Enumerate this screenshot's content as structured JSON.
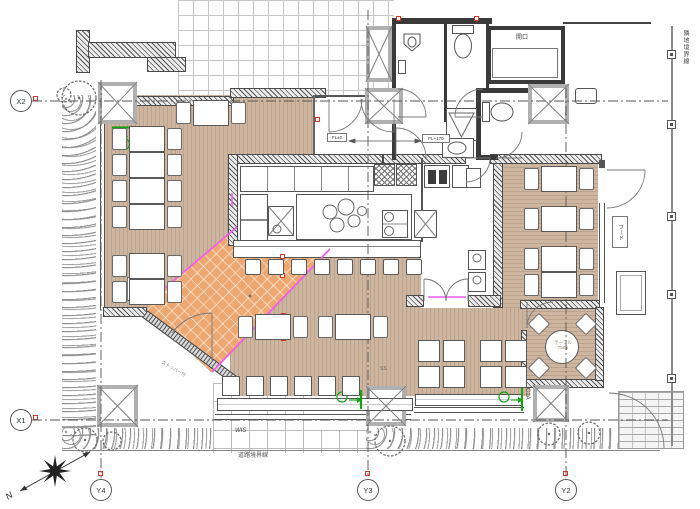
{
  "title": "restaurant-floor-plan",
  "axes": {
    "x2": "X2",
    "x1": "X1",
    "y4": "Y4",
    "y3": "Y3",
    "y2": "Y2"
  },
  "labels": {
    "opening": "開口",
    "adjacent_boundary": "隣地境界線",
    "road_boundary": "道路境界線",
    "hood": "フード",
    "column": "C1A",
    "station": "SS",
    "wis": "WIS",
    "stopper": "ストッパー付",
    "north": "N",
    "fl_left": "FL±0",
    "fl_right": "FL+170"
  },
  "table_spec": {
    "name": "テーブル",
    "w": "W600",
    "d": "D700"
  },
  "round_table": {
    "name": "テーブル",
    "size": "750φ"
  },
  "colors": {
    "floor_tan": "#cdb5a0",
    "terrace_orange": "#eda872",
    "line_magenta": "#ef5fe8",
    "marker_green": "#17a317",
    "marker_red": "#e03222"
  }
}
